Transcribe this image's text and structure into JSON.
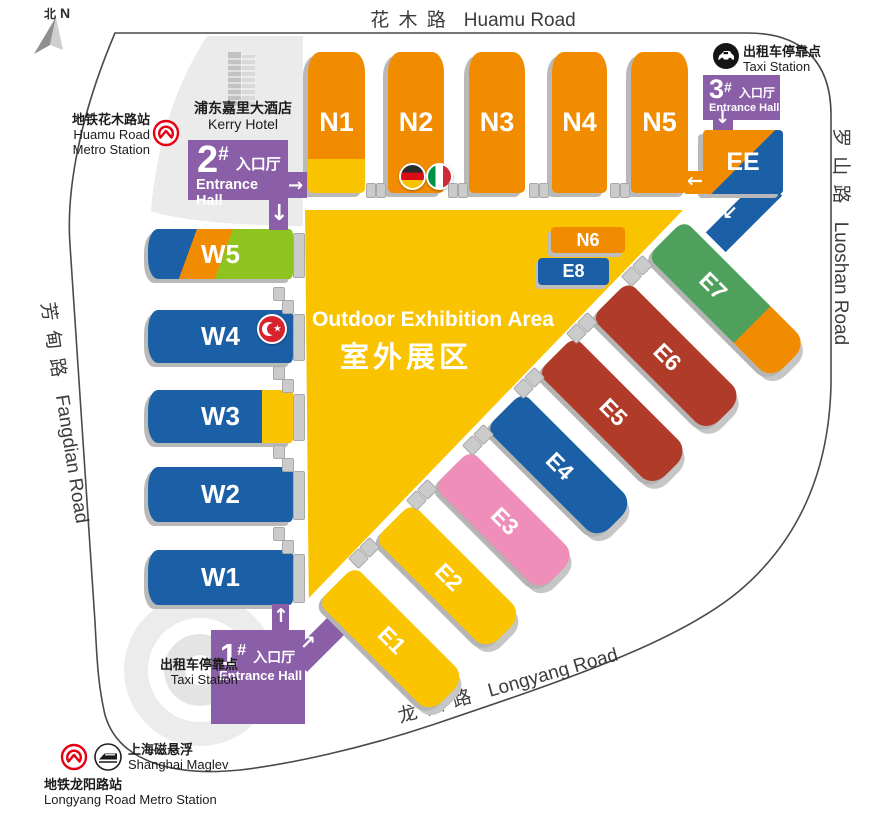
{
  "roads": {
    "top": {
      "zh": "花 木 路",
      "en": "Huamu Road"
    },
    "right": {
      "zh": "罗 山 路",
      "en": "Luoshan Road"
    },
    "left": {
      "zh": "芳 甸 路",
      "en": "Fangdian Road"
    },
    "bottom": {
      "zh": "龙 阳 路",
      "en": "Longyang Road"
    }
  },
  "compass": {
    "zh": "北",
    "en": "N"
  },
  "outdoor_area": {
    "en": "Outdoor Exhibition Area",
    "zh": "室外展区"
  },
  "hall_labels": {
    "n1": "N1",
    "n2": "N2",
    "n3": "N3",
    "n4": "N4",
    "n5": "N5",
    "n6": "N6",
    "e8": "E8",
    "ee": "EE",
    "e1": "E1",
    "e2": "E2",
    "e3": "E3",
    "e4": "E4",
    "e5": "E5",
    "e6": "E6",
    "e7": "E7",
    "w1": "W1",
    "w2": "W2",
    "w3": "W3",
    "w4": "W4",
    "w5": "W5"
  },
  "entrances": {
    "hall1": {
      "number": "1",
      "hash": "#",
      "zh": "入口厅",
      "en": "Entrance Hall"
    },
    "hall2": {
      "number": "2",
      "hash": "#",
      "zh": "入口厅",
      "en": "Entrance Hall"
    },
    "hall3": {
      "number": "3",
      "hash": "#",
      "zh": "入口厅",
      "en": "Entrance Hall"
    }
  },
  "pois": {
    "kerry_hotel": {
      "zh": "浦东嘉里大酒店",
      "en": "Kerry Hotel"
    },
    "huamu_metro": {
      "zh": "地铁花木路站",
      "en_line1": "Huamu Road",
      "en_line2": "Metro Station"
    },
    "taxi_northeast": {
      "zh": "出租车停靠点",
      "en": "Taxi Station"
    },
    "taxi_southwest": {
      "zh": "出租车停靠点",
      "en": "Taxi Station"
    },
    "maglev": {
      "zh": "上海磁悬浮",
      "en": "Shanghai Maglev"
    },
    "longyang_metro": {
      "zh": "地铁龙阳路站",
      "en": "Longyang Road Metro Station"
    }
  },
  "icons": {
    "arrow_down": "↓",
    "arrow_up": "↑",
    "arrow_left": "←",
    "arrow_right": "→",
    "arrow_up_right": "↗",
    "arrow_down_left": "↙",
    "star": "★"
  },
  "flags": {
    "n2_left": "Germany",
    "n2_right": "Italy",
    "w4": "Turkey"
  },
  "colors": {
    "hall_orange": "#F18C00",
    "hall_yellow": "#FBC400",
    "hall_blue": "#1B60A6",
    "hall_green": "#4FA05C",
    "hall_lime": "#8FC31F",
    "hall_red": "#B03B28",
    "hall_pink": "#EF8EB8",
    "entrance_purple": "#8A5FA8",
    "outdoor_yellow": "#FAC300",
    "metro_red": "#E60012",
    "edge_gray": "#B9B9B9"
  }
}
